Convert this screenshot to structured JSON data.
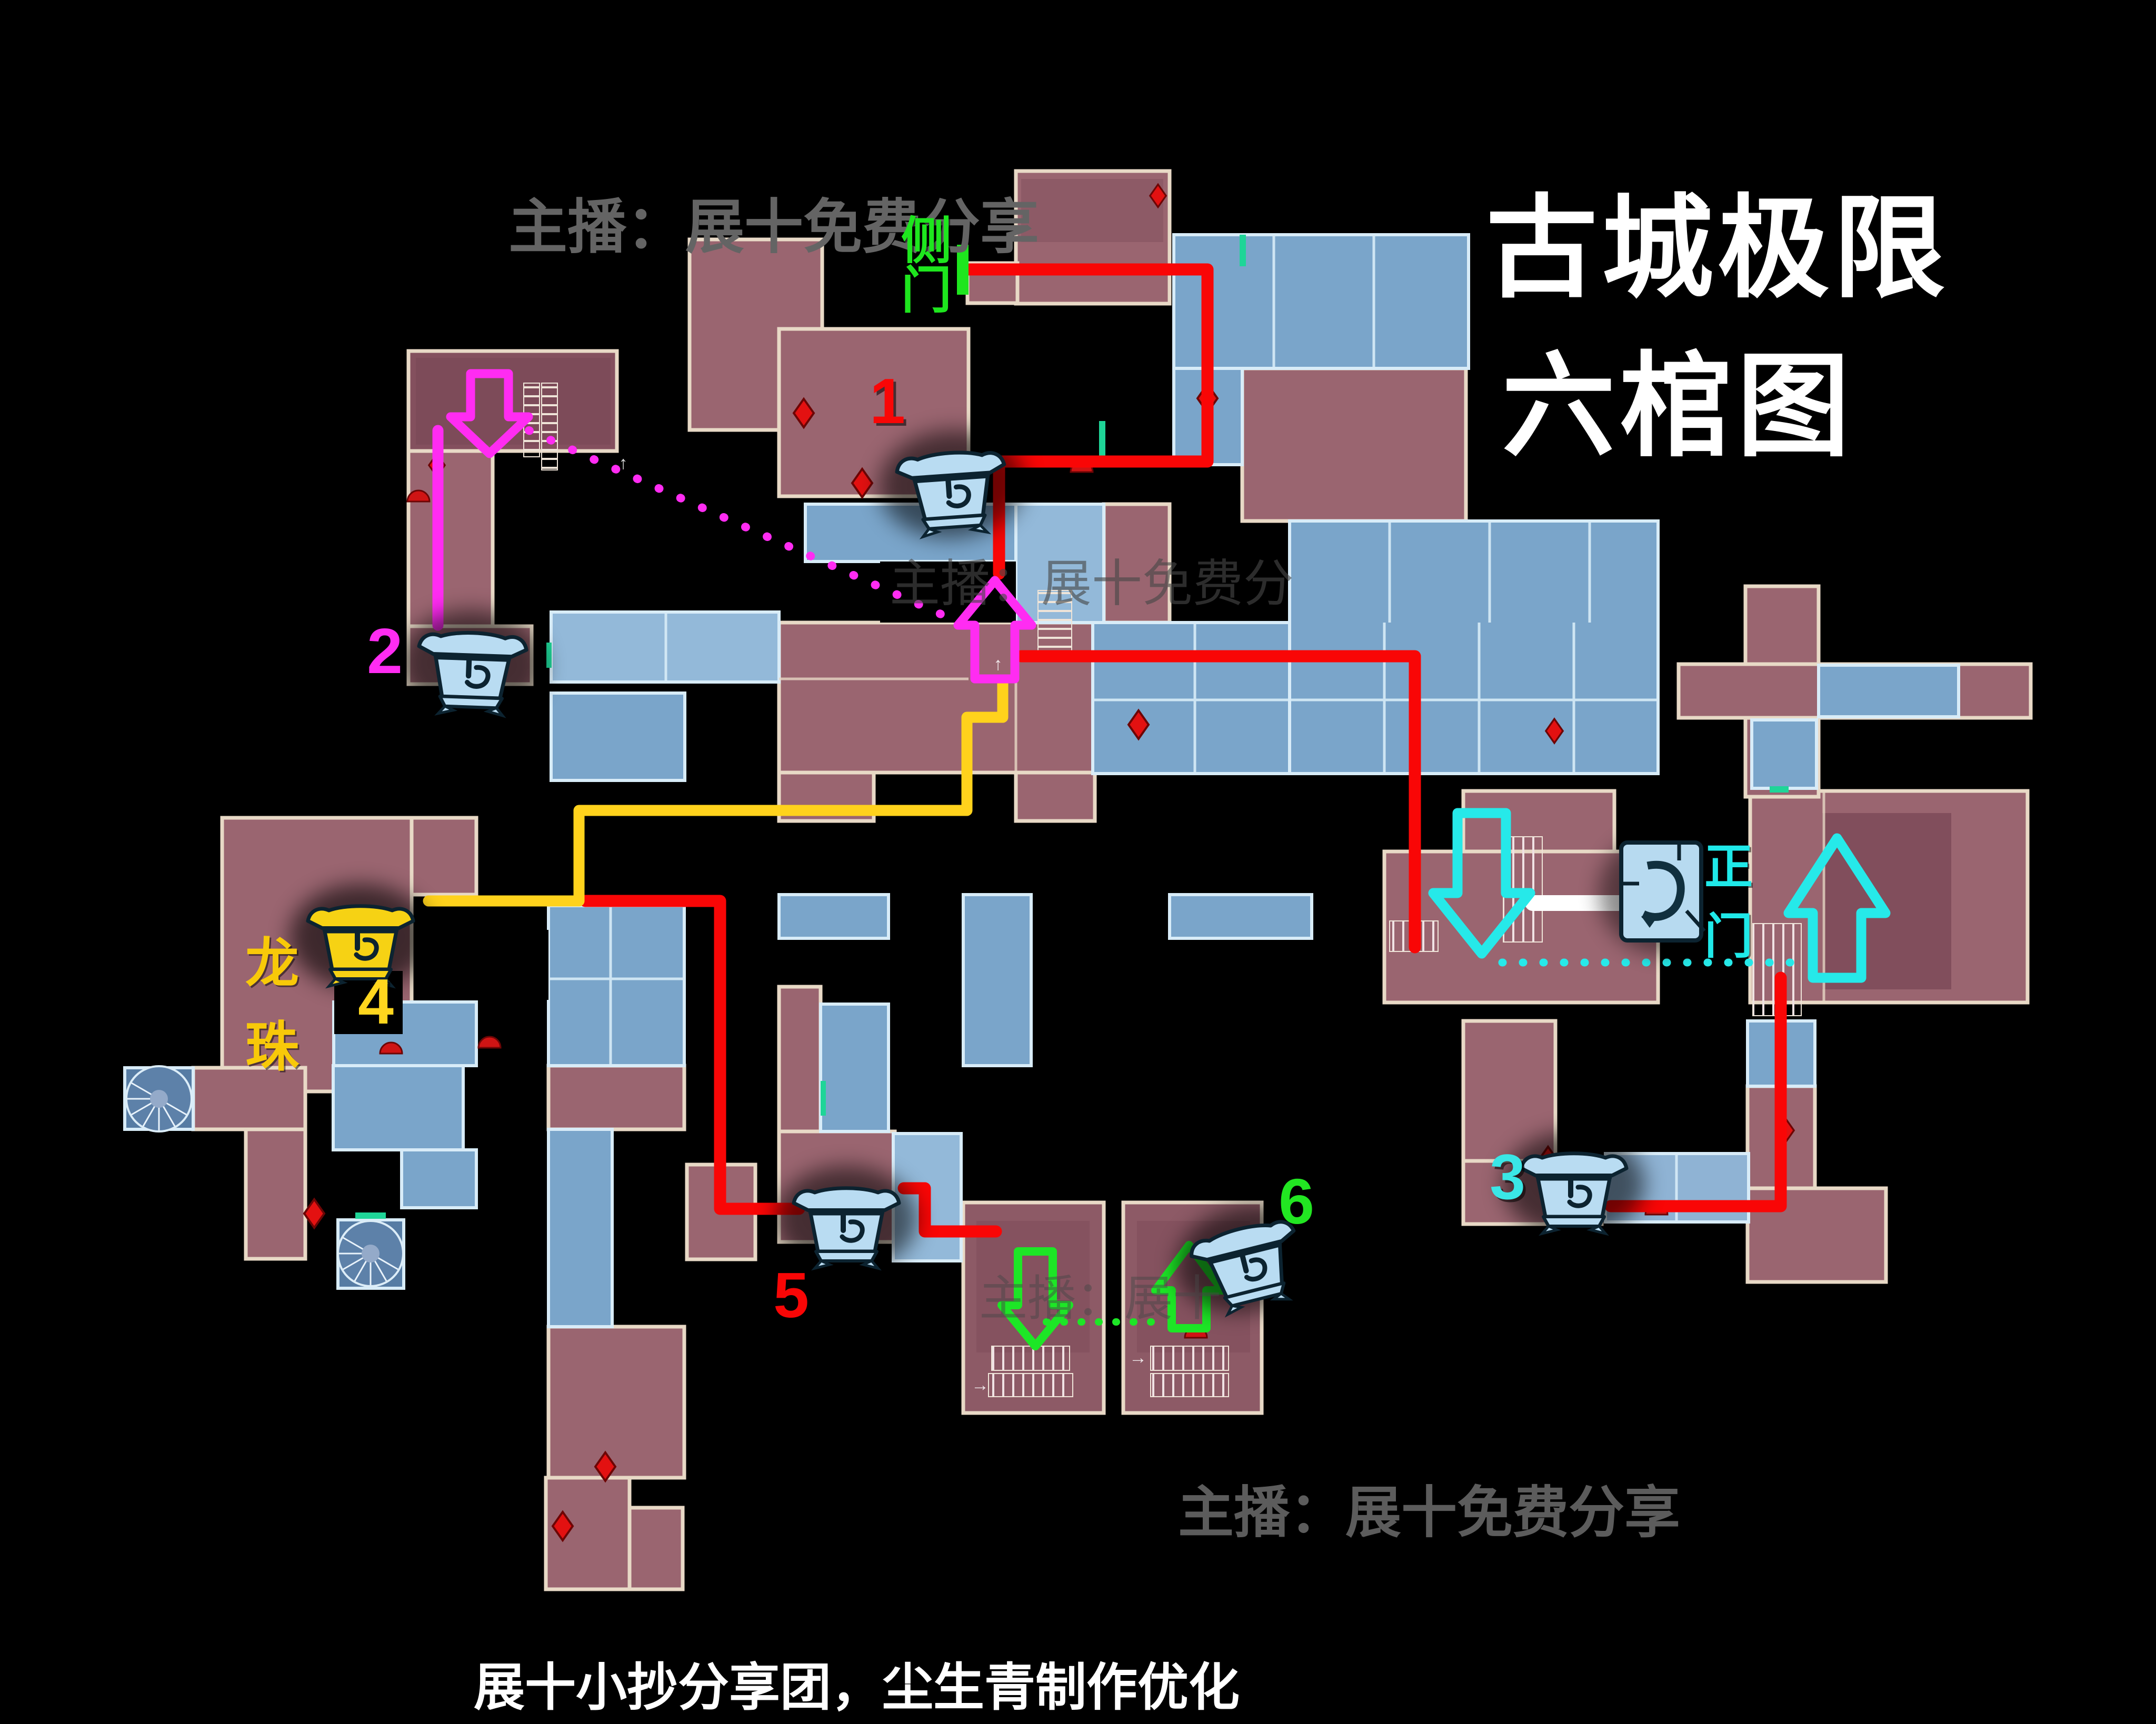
{
  "title": {
    "line1": "古城极限",
    "line2": "六棺图"
  },
  "watermarks": {
    "top": "主播：展十免费分享",
    "bottom": "主播：展十免费分享",
    "mid_upper": "主播：展十免费分",
    "mid_lower": "主播：展十",
    "credit": "展十小抄分享团，尘生青制作优化"
  },
  "labels": {
    "side_gate": "侧门",
    "main_gate": "正门",
    "dragon_pearl": "龙珠"
  },
  "coffins": [
    {
      "number": "1",
      "number_color": "#f90606",
      "icon": "coffin-icon",
      "icon_color": "#b9dcf2"
    },
    {
      "number": "2",
      "number_color": "#ff2cf2",
      "icon": "coffin-icon",
      "icon_color": "#b9dcf2"
    },
    {
      "number": "3",
      "number_color": "#3ae6e6",
      "icon": "coffin-icon",
      "icon_color": "#b9dcf2"
    },
    {
      "number": "4",
      "number_color": "#ffd61e",
      "icon": "coffin-icon",
      "icon_color": "#f6d214"
    },
    {
      "number": "5",
      "number_color": "#f90606",
      "icon": "coffin-icon",
      "icon_color": "#b9dcf2"
    },
    {
      "number": "6",
      "number_color": "#22e622",
      "icon": "coffin-icon",
      "icon_color": "#b9dcf2"
    }
  ],
  "routes": {
    "red": "#f90606",
    "yellow": "#ffd21c",
    "magenta": "#ff2cf2",
    "cyan": "#26e9e9",
    "green": "#1de626",
    "white": "#ffffff"
  },
  "map_colors": {
    "background": "#000000",
    "room_red": "#9a6570",
    "room_red_dark": "#84505e",
    "room_blue": "#7aa5ca",
    "room_blue_dark": "#5d81a9",
    "wall_red": "#e8d9c6",
    "wall_blue": "#d8ecf8",
    "marker_red": "#e31111",
    "door_teal": "#1fd598"
  },
  "stair_arrows": {
    "up": "↑",
    "right": "→"
  }
}
